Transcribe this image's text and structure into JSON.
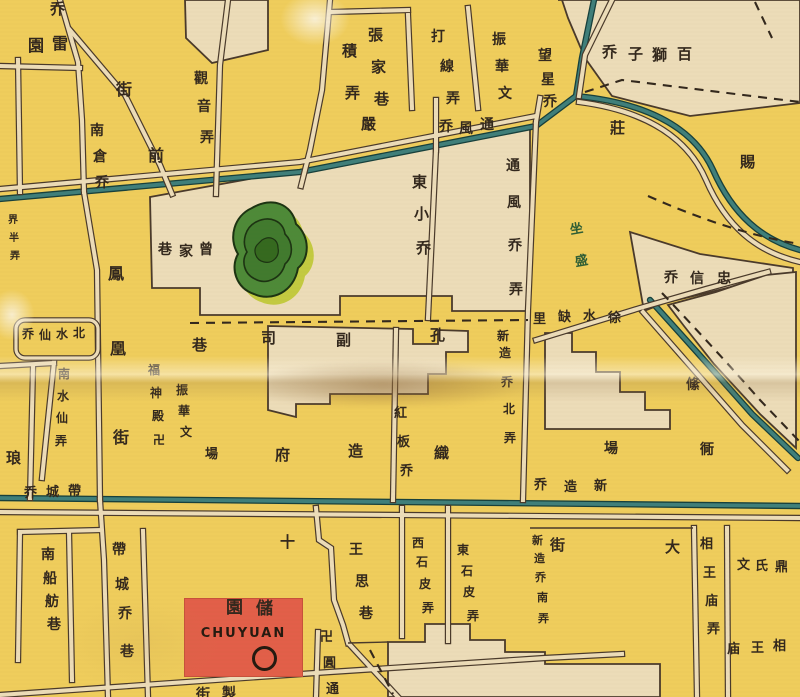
{
  "map_title": "Historical Suzhou city street map (scanned section)",
  "colors": {
    "background_yellow": "#efcd5c",
    "block_beige": "#ecdcb8",
    "ink": "#33281d",
    "street_line": "#4a3a2b",
    "canal_teal": "#3f7f7a",
    "canal_outline": "#17403c",
    "pond_green": "#4e8a38",
    "pond_halo": "#c3ca40",
    "landmark_red": "#e25f49",
    "garden_label_green": "#2f5e35"
  },
  "landmark_chuyuan": {
    "name_cn": "儲園",
    "name_latin": "CHUYUAN",
    "marker": "circle"
  },
  "labels": [
    {
      "name": "bridge-partial-top",
      "text": "乔",
      "size": 15,
      "chars": [
        [
          "乔",
          50,
          2
        ]
      ]
    },
    {
      "name": "leiyuan",
      "text": "雷園",
      "rtl": true,
      "size": 16,
      "chars": [
        [
          "園",
          28,
          38
        ],
        [
          "雷",
          52,
          36
        ]
      ]
    },
    {
      "name": "jilong",
      "text": "積弄",
      "size": 15,
      "chars": [
        [
          "積",
          342,
          44
        ],
        [
          "弄",
          345,
          86
        ]
      ]
    },
    {
      "name": "jie-guanqian",
      "text": "街",
      "size": 16,
      "chars": [
        [
          "街",
          116,
          82
        ]
      ]
    },
    {
      "name": "nancangqiao",
      "text": "南倉乔",
      "size": 14,
      "chars": [
        [
          "南",
          90,
          124
        ],
        [
          "倉",
          93,
          150
        ],
        [
          "乔",
          95,
          176
        ]
      ]
    },
    {
      "name": "qian",
      "text": "前",
      "size": 16,
      "chars": [
        [
          "前",
          148,
          148
        ]
      ]
    },
    {
      "name": "guanyinlong",
      "text": "觀音弄",
      "size": 14,
      "chars": [
        [
          "觀",
          194,
          72
        ],
        [
          "音",
          197,
          100
        ],
        [
          "弄",
          200,
          131
        ]
      ]
    },
    {
      "name": "zhangjiaxiang",
      "text": "張家巷",
      "size": 15,
      "chars": [
        [
          "張",
          368,
          28
        ],
        [
          "家",
          371,
          60
        ],
        [
          "巷",
          374,
          92
        ]
      ]
    },
    {
      "name": "daxianlong",
      "text": "打線弄",
      "size": 14,
      "chars": [
        [
          "打",
          431,
          30
        ],
        [
          "線",
          440,
          60
        ],
        [
          "弄",
          446,
          92
        ]
      ]
    },
    {
      "name": "zhenhua-north",
      "text": "振華文",
      "size": 14,
      "chars": [
        [
          "振",
          492,
          33
        ],
        [
          "華",
          495,
          60
        ],
        [
          "文",
          498,
          87
        ]
      ]
    },
    {
      "name": "yan",
      "text": "嚴",
      "size": 15,
      "chars": [
        [
          "嚴",
          361,
          117
        ]
      ]
    },
    {
      "name": "tongfengqiao",
      "text": "通風乔",
      "rtl": true,
      "size": 14,
      "chars": [
        [
          "乔",
          439,
          120
        ],
        [
          "風",
          459,
          122
        ],
        [
          "通",
          480,
          118
        ]
      ]
    },
    {
      "name": "wangxingqiao",
      "text": "望星乔",
      "size": 14,
      "chars": [
        [
          "望",
          538,
          49
        ],
        [
          "星",
          541,
          73
        ],
        [
          "乔",
          543,
          95
        ]
      ]
    },
    {
      "name": "baishiziqiao",
      "text": "百獅子乔",
      "rtl": true,
      "size": 15,
      "chars": [
        [
          "乔",
          602,
          45
        ],
        [
          "子",
          628,
          47
        ],
        [
          "獅",
          652,
          48
        ],
        [
          "百",
          677,
          47
        ]
      ]
    },
    {
      "name": "zhuang",
      "text": "莊",
      "size": 15,
      "chars": [
        [
          "莊",
          610,
          121
        ]
      ]
    },
    {
      "name": "ci",
      "text": "賜",
      "size": 15,
      "chars": [
        [
          "賜",
          740,
          155
        ]
      ]
    },
    {
      "name": "tongfengqiaolong",
      "text": "通風乔弄",
      "size": 14,
      "chars": [
        [
          "通",
          506,
          159
        ],
        [
          "風",
          507,
          196
        ],
        [
          "乔",
          508,
          239
        ],
        [
          "弄",
          509,
          283
        ]
      ]
    },
    {
      "name": "garden-green",
      "text": "坐盛",
      "color": "green",
      "size": 13,
      "rot": -10,
      "chars": [
        [
          "坐",
          570,
          223
        ],
        [
          "盛",
          575,
          255
        ]
      ]
    },
    {
      "name": "zengjiaxiang",
      "text": "曾家巷",
      "rtl": true,
      "size": 14,
      "chars": [
        [
          "巷",
          158,
          243
        ],
        [
          "家",
          179,
          245
        ],
        [
          "曾",
          199,
          243
        ]
      ]
    },
    {
      "name": "fenghuangjie",
      "text": "鳳凰街",
      "size": 16,
      "chars": [
        [
          "鳳",
          108,
          266
        ],
        [
          "凰",
          110,
          341
        ],
        [
          "街",
          113,
          430
        ]
      ]
    },
    {
      "name": "beishuixianqiao",
      "text": "北水仙乔",
      "rtl": true,
      "size": 12,
      "chars": [
        [
          "乔",
          22,
          328
        ],
        [
          "仙",
          39,
          329
        ],
        [
          "水",
          56,
          328
        ],
        [
          "北",
          73,
          327
        ]
      ]
    },
    {
      "name": "nanshuixianlong",
      "text": "南水仙弄",
      "size": 12,
      "chars": [
        [
          "南",
          58,
          368
        ],
        [
          "水",
          57,
          390
        ],
        [
          "仙",
          56,
          412
        ],
        [
          "弄",
          55,
          435
        ]
      ]
    },
    {
      "name": "lang",
      "text": "琅",
      "size": 15,
      "chars": [
        [
          "琅",
          6,
          451
        ]
      ]
    },
    {
      "name": "fushendian",
      "text": "福神殿卍",
      "size": 12,
      "chars": [
        [
          "福",
          148,
          364
        ],
        [
          "神",
          150,
          387
        ],
        [
          "殿",
          152,
          410
        ],
        [
          "卍",
          153,
          434
        ]
      ]
    },
    {
      "name": "zhenhua-south",
      "text": "振華文",
      "size": 12,
      "chars": [
        [
          "振",
          176,
          384
        ],
        [
          "華",
          178,
          405
        ],
        [
          "文",
          180,
          426
        ]
      ]
    },
    {
      "name": "chang-west",
      "text": "場",
      "size": 13,
      "chars": [
        [
          "場",
          205,
          448
        ]
      ]
    },
    {
      "name": "kongfusixiang",
      "text": "孔副司巷",
      "rtl": true,
      "size": 15,
      "chars": [
        [
          "巷",
          192,
          338
        ],
        [
          "司",
          261,
          331
        ],
        [
          "副",
          336,
          333
        ],
        [
          "孔",
          430,
          328
        ]
      ]
    },
    {
      "name": "xinzaoqiaobeilong",
      "text": "新造乔北弄",
      "size": 12,
      "chars": [
        [
          "新",
          497,
          330
        ],
        [
          "造",
          499,
          347
        ],
        [
          "乔",
          501,
          376
        ],
        [
          "北",
          503,
          403
        ],
        [
          "弄",
          504,
          432
        ]
      ]
    },
    {
      "name": "hongbanqiao",
      "text": "紅板乔",
      "size": 13,
      "chars": [
        [
          "紅",
          394,
          407
        ],
        [
          "板",
          397,
          436
        ],
        [
          "乔",
          400,
          465
        ]
      ]
    },
    {
      "name": "zhizaofu",
      "text": "織造府",
      "rtl": true,
      "size": 15,
      "chars": [
        [
          "府",
          275,
          448
        ],
        [
          "造",
          348,
          444
        ],
        [
          "織",
          434,
          446
        ]
      ]
    },
    {
      "name": "xushuiqueli",
      "text": "徐水缺里",
      "rtl": true,
      "size": 13,
      "chars": [
        [
          "里",
          533,
          313
        ],
        [
          "缺",
          558,
          311
        ],
        [
          "水",
          583,
          310
        ],
        [
          "徐",
          608,
          312
        ]
      ]
    },
    {
      "name": "tao",
      "text": "絛",
      "size": 14,
      "chars": [
        [
          "絛",
          686,
          378
        ]
      ]
    },
    {
      "name": "chang-east",
      "text": "場",
      "size": 14,
      "chars": [
        [
          "場",
          604,
          442
        ]
      ]
    },
    {
      "name": "tong-east",
      "text": "衕",
      "size": 14,
      "chars": [
        [
          "衕",
          700,
          443
        ]
      ]
    },
    {
      "name": "zhongxinqiao",
      "text": "忠信乔",
      "rtl": true,
      "size": 14,
      "chars": [
        [
          "乔",
          664,
          271
        ],
        [
          "信",
          690,
          272
        ],
        [
          "忠",
          717,
          272
        ]
      ]
    },
    {
      "name": "xinzaoqiao-street",
      "text": "新造乔",
      "rtl": true,
      "size": 13,
      "chars": [
        [
          "乔",
          534,
          479
        ],
        [
          "造",
          564,
          481
        ],
        [
          "新",
          594,
          480
        ]
      ]
    },
    {
      "name": "daichengqiao",
      "text": "帶城乔",
      "rtl": true,
      "size": 13,
      "chars": [
        [
          "乔",
          24,
          487
        ],
        [
          "城",
          46,
          486
        ],
        [
          "帶",
          68,
          485
        ]
      ]
    },
    {
      "name": "daichengqiaoxiang",
      "text": "帶城乔巷",
      "size": 14,
      "chars": [
        [
          "帶",
          112,
          543
        ],
        [
          "城",
          115,
          578
        ],
        [
          "乔",
          118,
          607
        ],
        [
          "巷",
          120,
          645
        ]
      ]
    },
    {
      "name": "nanchuanfangxiang",
      "text": "南船舫巷",
      "size": 14,
      "chars": [
        [
          "南",
          41,
          548
        ],
        [
          "船",
          43,
          572
        ],
        [
          "舫",
          45,
          595
        ],
        [
          "巷",
          47,
          618
        ]
      ]
    },
    {
      "name": "shi-char",
      "text": "十",
      "size": 15,
      "chars": [
        [
          "十",
          280,
          535
        ]
      ]
    },
    {
      "name": "wangsixiang",
      "text": "王思巷",
      "size": 14,
      "chars": [
        [
          "王",
          349,
          543
        ],
        [
          "思",
          355,
          575
        ],
        [
          "巷",
          359,
          607
        ]
      ]
    },
    {
      "name": "xishipilong",
      "text": "西石皮弄",
      "size": 12,
      "chars": [
        [
          "西",
          412,
          537
        ],
        [
          "石",
          416,
          556
        ],
        [
          "皮",
          419,
          578
        ],
        [
          "弄",
          422,
          602
        ]
      ]
    },
    {
      "name": "dongshipilong",
      "text": "東石皮弄",
      "size": 12,
      "chars": [
        [
          "東",
          457,
          544
        ],
        [
          "石",
          461,
          565
        ],
        [
          "皮",
          463,
          586
        ],
        [
          "弄",
          467,
          610
        ]
      ]
    },
    {
      "name": "xinzaoqiaonanlong",
      "text": "新造乔南弄",
      "size": 11,
      "chars": [
        [
          "新",
          532,
          535
        ],
        [
          "造",
          534,
          553
        ],
        [
          "乔",
          535,
          572
        ],
        [
          "南",
          537,
          592
        ],
        [
          "弄",
          538,
          613
        ]
      ]
    },
    {
      "name": "jie-da",
      "text": "街",
      "size": 15,
      "chars": [
        [
          "街",
          550,
          538
        ]
      ]
    },
    {
      "name": "da-char",
      "text": "大",
      "size": 15,
      "chars": [
        [
          "大",
          665,
          540
        ]
      ]
    },
    {
      "name": "xiangwangmiaolong",
      "text": "相王庙弄",
      "size": 13,
      "chars": [
        [
          "相",
          700,
          538
        ],
        [
          "王",
          703,
          567
        ],
        [
          "庙",
          705,
          595
        ],
        [
          "弄",
          707,
          623
        ]
      ]
    },
    {
      "name": "wenshiding",
      "text": "文氏鼎",
      "size": 13,
      "chars": [
        [
          "文",
          737,
          559
        ],
        [
          "氏",
          755,
          560
        ],
        [
          "鼎",
          775,
          561
        ]
      ]
    },
    {
      "name": "xiangwangmiao",
      "text": "相王庙",
      "rtl": true,
      "size": 13,
      "chars": [
        [
          "庙",
          727,
          643
        ],
        [
          "王",
          751,
          642
        ],
        [
          "相",
          773,
          640
        ]
      ]
    },
    {
      "name": "chuyuan-cn",
      "text": "儲園",
      "rtl": true,
      "size": 17,
      "chars": [
        [
          "園",
          226,
          600
        ],
        [
          "儲",
          256,
          601
        ]
      ]
    },
    {
      "name": "wanyuantong",
      "text": "卍圓通",
      "size": 13,
      "chars": [
        [
          "卍",
          320,
          631
        ],
        [
          "圓",
          323,
          657
        ],
        [
          "通",
          326,
          683
        ]
      ]
    },
    {
      "name": "bottom-street-partial",
      "text": "十全街(clipped)",
      "size": 14,
      "chars": [
        [
          "街",
          196,
          688
        ],
        [
          "製",
          222,
          687
        ]
      ]
    },
    {
      "name": "edge-tiny-label",
      "text": "界半弄",
      "size": 10,
      "chars": [
        [
          "界",
          8,
          216
        ],
        [
          "半",
          9,
          234
        ],
        [
          "弄",
          10,
          252
        ]
      ]
    },
    {
      "name": "dongxiaoqiao",
      "text": "東小乔",
      "size": 15,
      "chars": [
        [
          "東",
          412,
          175
        ],
        [
          "小",
          414,
          207
        ],
        [
          "乔",
          416,
          241
        ]
      ]
    }
  ]
}
